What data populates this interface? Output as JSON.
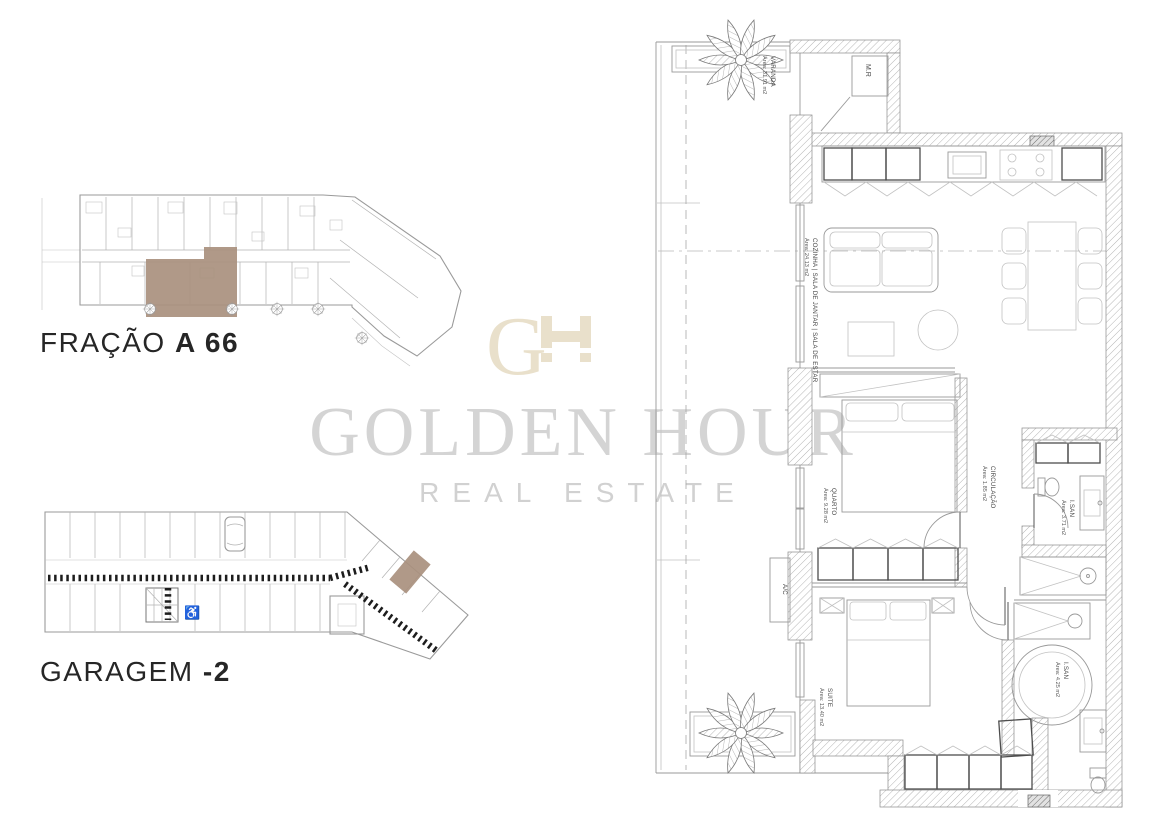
{
  "page": {
    "width": 1162,
    "height": 814,
    "background": "#ffffff"
  },
  "plans": {
    "unit_plan_label": {
      "prefix": "FRAÇÃO",
      "value": "A 66"
    },
    "garage_plan_label": {
      "prefix": "GARAGEM",
      "value": "-2"
    },
    "highlight_color": "#a9907e"
  },
  "watermark": {
    "monogram_g": "G",
    "monogram": "GH",
    "title": "GOLDEN HOUR",
    "subtitle": "REAL ESTATE",
    "title_color": "#d4d4d4",
    "monogram_color": "#e9e0cb"
  },
  "icons": {
    "accessible_parking": "♿"
  },
  "apartment": {
    "rooms": {
      "varanda": {
        "name": "VARANDA",
        "area": "Área: 31.91 m2"
      },
      "mr": {
        "name": "M.R"
      },
      "living": {
        "name": "COZINHA | SALA DE JANTAR | SALA DE ESTAR",
        "area": "Área: 24.13 m2"
      },
      "quarto": {
        "name": "QUARTO",
        "area": "Área: 9.28 m2"
      },
      "circulacao": {
        "name": "CIRCULAÇÃO",
        "area": "Área: 1.85 m2"
      },
      "isan_top": {
        "name": "I.SAN",
        "area": "Área: 3.71 m2"
      },
      "ac": {
        "name": "A/C"
      },
      "suite": {
        "name": "SUITE",
        "area": "Área: 13.40 m2"
      },
      "isan_bottom": {
        "name": "I.SAN",
        "area": "Área: 4.25 m2"
      }
    }
  }
}
